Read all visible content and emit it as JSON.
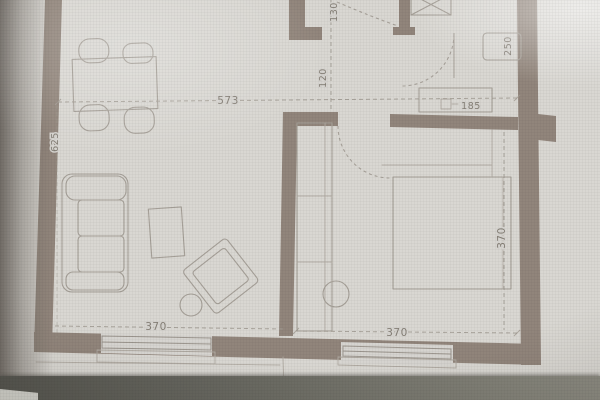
{
  "colors": {
    "paper": "#d9d7d2",
    "wall": "#92857b",
    "furniture_line": "#a6a098",
    "dim_line": "#a19b92",
    "dim_text": "#85randomness7f76",
    "text": "#857f76",
    "photo_band": "#5c5c55"
  },
  "dims": {
    "living_width": "573",
    "living_height": "625",
    "living_window_width": "370",
    "hall_width_top": "130",
    "hall_width_mid": "120",
    "kitchen_counter_depth": "250",
    "kitchen_unit_width": "185",
    "bedroom_width": "370",
    "bedroom_depth": "370"
  }
}
